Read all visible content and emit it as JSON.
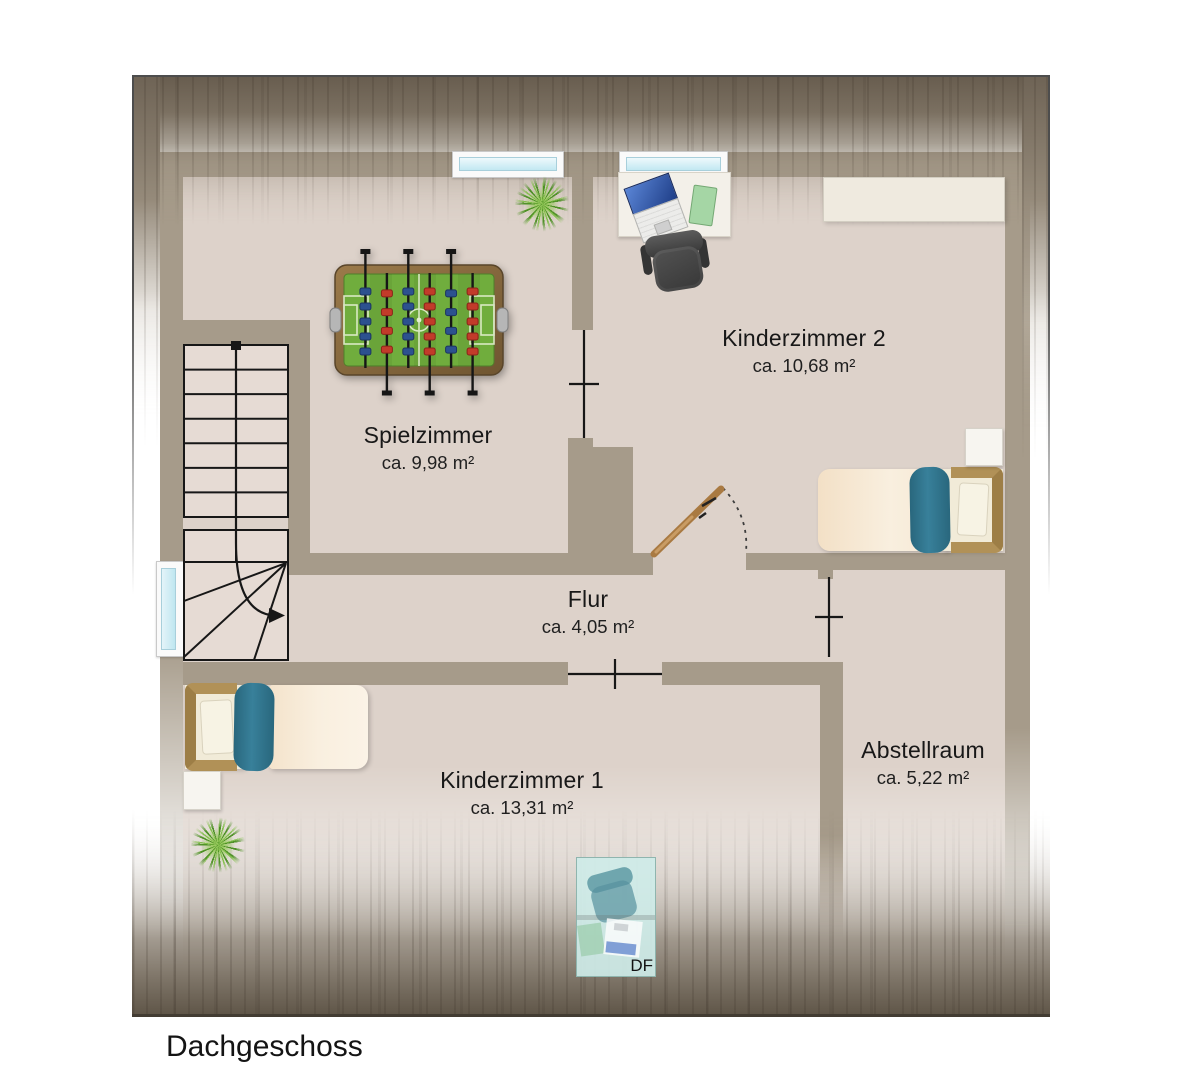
{
  "plan_title": "Dachgeschoss",
  "rooms": [
    {
      "name": "Spielzimmer",
      "area": "ca. 9,98 m²"
    },
    {
      "name": "Kinderzimmer 2",
      "area": "ca. 10,68 m²"
    },
    {
      "name": "Flur",
      "area": "ca. 4,05 m²"
    },
    {
      "name": "Kinderzimmer 1",
      "area": "ca. 13,31 m²"
    },
    {
      "name": "Abstellraum",
      "area": "ca. 5,22 m²"
    }
  ],
  "labels": {
    "roof_window": "DF"
  },
  "colors": {
    "wall": "#a69b8a",
    "floor": "#ddd2ca",
    "roof_shade_dark": "#675c4e",
    "window_glass": "#c2e8f2",
    "door_wood": "#a97a42",
    "bed_accent_teal": "#2f7389",
    "bed_blanket": "#f6e8d4",
    "headboard_tan": "#b19157",
    "foosball_field_green": "#70ad3d",
    "player_red": "#c23b2a",
    "player_blue": "#2c518f",
    "plant_green": "#7abc40",
    "roof_window_tint": "#cdece8"
  }
}
